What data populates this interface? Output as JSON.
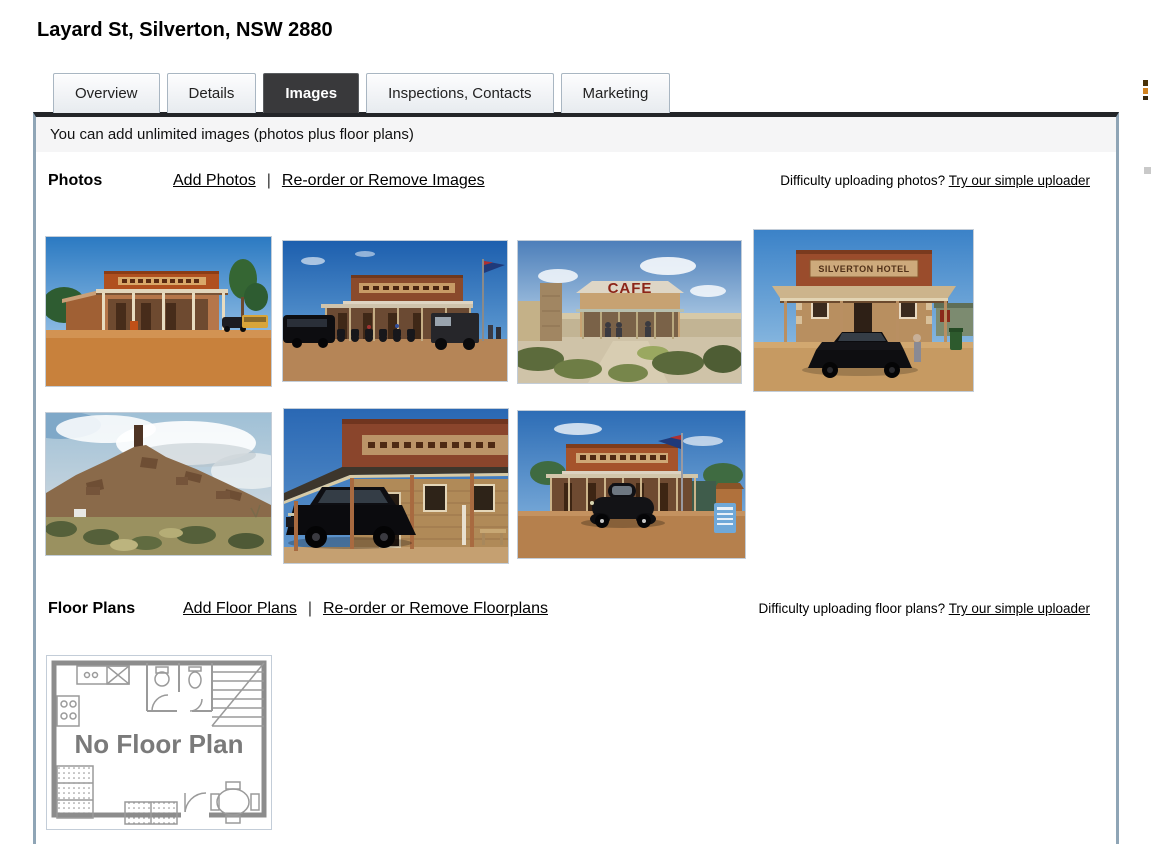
{
  "colors": {
    "active_tab_bg": "#39393b",
    "panel_border": "#8fa5b6",
    "panel_top_border": "#232528",
    "notice_bg": "#f5f5f6",
    "tab_border": "#a9b6c2"
  },
  "header": {
    "title": "Layard St, Silverton, NSW 2880"
  },
  "tabs": [
    {
      "label": "Overview",
      "active": false
    },
    {
      "label": "Details",
      "active": false
    },
    {
      "label": "Images",
      "active": true
    },
    {
      "label": "Inspections, Contacts",
      "active": false
    },
    {
      "label": "Marketing",
      "active": false
    }
  ],
  "notice": {
    "text": "You can add unlimited images (photos plus floor plans)"
  },
  "photos": {
    "heading": "Photos",
    "add_link": "Add Photos",
    "separator": "|",
    "reorder_link": "Re-order or Remove Images",
    "help_text": "Difficulty uploading photos?",
    "help_link": "Try our simple uploader",
    "thumbnails": [
      {
        "alt": "Silverton Hotel street view with trees and red dirt"
      },
      {
        "alt": "Silverton Hotel with motorcycles parked out front"
      },
      {
        "alt": "Silverton cafe with CAFE roof sign and garden",
        "sign_text": "CAFE"
      },
      {
        "alt": "Silverton Hotel facade with black muscle car",
        "sign_text": "SILVERTON HOTEL"
      },
      {
        "alt": "Hill with mine chimney ruins and scrubland"
      },
      {
        "alt": "Silverton Hotel veranda close-up with black muscle car"
      },
      {
        "alt": "Silverton Hotel with vintage black car and flag"
      }
    ]
  },
  "floorplans": {
    "heading": "Floor Plans",
    "add_link": "Add Floor Plans",
    "separator": "|",
    "reorder_link": "Re-order or Remove Floorplans",
    "help_text": "Difficulty uploading floor plans?",
    "help_link": "Try our simple uploader",
    "placeholder": {
      "alt": "No floor plan placeholder image",
      "label": "No Floor Plan"
    }
  }
}
